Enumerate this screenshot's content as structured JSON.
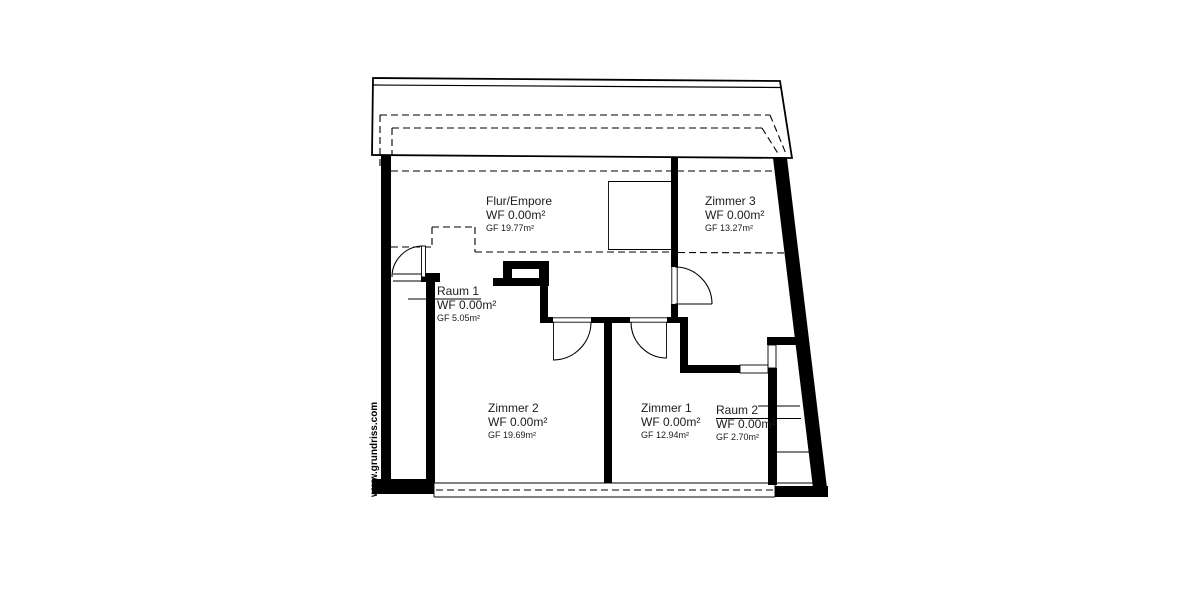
{
  "watermark": "www.grundriss.com",
  "rooms": [
    {
      "name": "Flur/Empore",
      "wf": "WF 0.00m²",
      "gf": "GF 19.77m²"
    },
    {
      "name": "Zimmer 3",
      "wf": "WF 0.00m²",
      "gf": "GF 13.27m²"
    },
    {
      "name": "Raum 1",
      "wf": "WF 0.00m²",
      "gf": "GF 5.05m²"
    },
    {
      "name": "Zimmer 2",
      "wf": "WF 0.00m²",
      "gf": "GF 19.69m²"
    },
    {
      "name": "Zimmer 1",
      "wf": "WF 0.00m²",
      "gf": "GF 12.94m²"
    },
    {
      "name": "Raum 2",
      "wf": "WF 0.00m²",
      "gf": "GF 2.70m²"
    }
  ],
  "colors": {
    "line": "#000000",
    "text": "#1c1c1c",
    "background": "#ffffff"
  }
}
